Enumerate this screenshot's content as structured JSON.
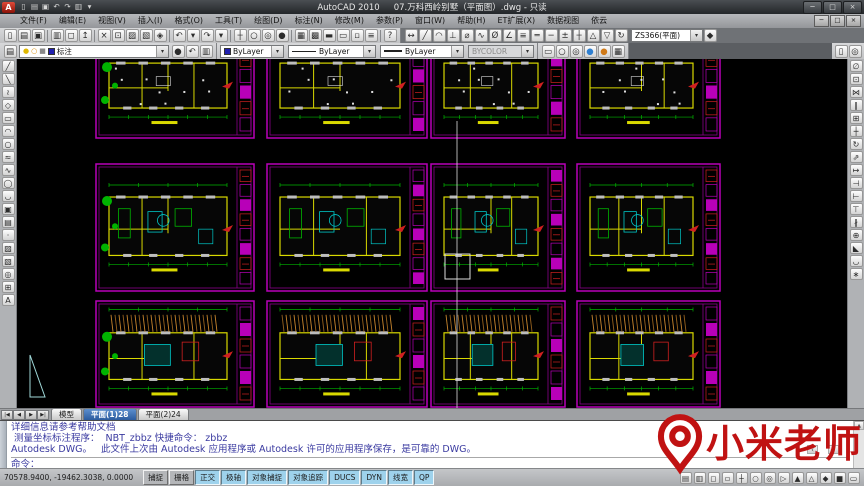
{
  "window": {
    "logo_letter": "A",
    "app_title": "AutoCAD 2010",
    "doc_title": "07.万科西岭别墅（平面图）.dwg - 只读",
    "controls": [
      {
        "name": "minimize",
        "glyph": "─"
      },
      {
        "name": "maximize",
        "glyph": "□"
      },
      {
        "name": "close",
        "glyph": "×"
      }
    ]
  },
  "quick_access": [
    {
      "name": "qnew",
      "glyph": "▯"
    },
    {
      "name": "open",
      "glyph": "▤"
    },
    {
      "name": "save",
      "glyph": "▣"
    },
    {
      "name": "undo",
      "glyph": "↶"
    },
    {
      "name": "redo",
      "glyph": "↷"
    },
    {
      "name": "plot",
      "glyph": "▥"
    },
    {
      "name": "qat-options",
      "glyph": "▾"
    }
  ],
  "menu": {
    "items": [
      "文件(F)",
      "编辑(E)",
      "视图(V)",
      "插入(I)",
      "格式(O)",
      "工具(T)",
      "绘图(D)",
      "标注(N)",
      "修改(M)",
      "参数(P)",
      "窗口(W)",
      "帮助(H)",
      "ET扩展(X)",
      "数据视图",
      "依云"
    ],
    "mdi_controls": [
      {
        "name": "mdi-minimize",
        "glyph": "─"
      },
      {
        "name": "mdi-restore",
        "glyph": "□"
      },
      {
        "name": "mdi-close",
        "glyph": "×"
      }
    ]
  },
  "toolbar_standard": [
    {
      "name": "qnew",
      "glyph": "▯"
    },
    {
      "name": "open",
      "glyph": "▤"
    },
    {
      "name": "save",
      "glyph": "▣"
    },
    {
      "name": "sep",
      "sep": true
    },
    {
      "name": "plot",
      "glyph": "▥"
    },
    {
      "name": "plot-preview",
      "glyph": "◻"
    },
    {
      "name": "publish",
      "glyph": "↥"
    },
    {
      "name": "sep",
      "sep": true
    },
    {
      "name": "cut",
      "glyph": "×"
    },
    {
      "name": "copy",
      "glyph": "⊡"
    },
    {
      "name": "paste",
      "glyph": "▨"
    },
    {
      "name": "match-properties",
      "glyph": "▧"
    },
    {
      "name": "block-editor",
      "glyph": "◈"
    },
    {
      "name": "sep",
      "sep": true
    },
    {
      "name": "undo",
      "glyph": "↶"
    },
    {
      "name": "undo-drop",
      "glyph": "▾"
    },
    {
      "name": "redo",
      "glyph": "↷"
    },
    {
      "name": "redo-drop",
      "glyph": "▾"
    },
    {
      "name": "sep",
      "sep": true
    },
    {
      "name": "pan",
      "glyph": "┼"
    },
    {
      "name": "zoom-realtime",
      "glyph": "○"
    },
    {
      "name": "zoom-window",
      "glyph": "◎"
    },
    {
      "name": "zoom-previous",
      "glyph": "●"
    },
    {
      "name": "sep",
      "sep": true
    },
    {
      "name": "properties",
      "glyph": "▦"
    },
    {
      "name": "designcenter",
      "glyph": "▩"
    },
    {
      "name": "tool-palettes",
      "glyph": "▬"
    },
    {
      "name": "sheetset-manager",
      "glyph": "▭"
    },
    {
      "name": "markup-manager",
      "glyph": "▫"
    },
    {
      "name": "quickcalc",
      "glyph": "≡"
    },
    {
      "name": "sep",
      "sep": true
    },
    {
      "name": "help",
      "glyph": "?"
    }
  ],
  "toolbar_dimension": {
    "icons": [
      {
        "name": "linear-dimension",
        "glyph": "↔"
      },
      {
        "name": "aligned-dimension",
        "glyph": "╱"
      },
      {
        "name": "arc-length-dimension",
        "glyph": "◠"
      },
      {
        "name": "ordinate-dimension",
        "glyph": "⊥"
      },
      {
        "name": "radius-dimension",
        "glyph": "⌀"
      },
      {
        "name": "jogged-dimension",
        "glyph": "∿"
      },
      {
        "name": "diameter-dimension",
        "glyph": "Ø"
      },
      {
        "name": "angular-dimension",
        "glyph": "∠"
      },
      {
        "name": "quick-dimension",
        "glyph": "≡"
      },
      {
        "name": "baseline-dimension",
        "glyph": "═"
      },
      {
        "name": "continue-dimension",
        "glyph": "─"
      },
      {
        "name": "tolerance",
        "glyph": "±"
      },
      {
        "name": "center-mark",
        "glyph": "┼"
      },
      {
        "name": "dimension-edit",
        "glyph": "△"
      },
      {
        "name": "dimension-text-edit",
        "glyph": "▽"
      },
      {
        "name": "dimension-update",
        "glyph": "↻"
      }
    ],
    "style_value": "ZS366(平面)",
    "tail_icon": {
      "name": "dim-style-control",
      "glyph": "◆"
    }
  },
  "toolbar_layers": {
    "manager_icon": {
      "name": "layer-properties-manager",
      "glyph": "▤"
    },
    "state_icons": [
      {
        "name": "layer-on-bulb",
        "glyph": "●",
        "color": "#e0b800"
      },
      {
        "name": "layer-freeze-sun",
        "glyph": "○",
        "color": "#d88a00"
      },
      {
        "name": "layer-lock",
        "glyph": "■",
        "color": "#8a8a8a"
      }
    ],
    "layer_swatch": "#2020b0",
    "layer_name": "标注",
    "after_icons": [
      {
        "name": "make-object-layer-current",
        "glyph": "●"
      },
      {
        "name": "layer-previous",
        "glyph": "↶"
      },
      {
        "name": "layer-states",
        "glyph": "▥"
      }
    ]
  },
  "toolbar_properties": {
    "color_swatch": "#2020b0",
    "color": "ByLayer",
    "linetype": "ByLayer",
    "lineweight": "ByLayer",
    "plot_style": "BYCOLOR"
  },
  "toolbar_render": [
    {
      "name": "hide",
      "glyph": "▭"
    },
    {
      "name": "wireframe",
      "glyph": "○"
    },
    {
      "name": "visual-styles",
      "glyph": "◎"
    },
    {
      "name": "shaded-sphere",
      "glyph": "●",
      "color": "#2f7fd0"
    },
    {
      "name": "realistic-sphere",
      "glyph": "●",
      "color": "#d07a18"
    },
    {
      "name": "render",
      "glyph": "▦"
    }
  ],
  "toolbar_corner": [
    {
      "name": "properties-palette",
      "glyph": "▯"
    },
    {
      "name": "quickcalc-palette",
      "glyph": "◎"
    }
  ],
  "draw_toolbar": [
    {
      "name": "line",
      "glyph": "╱"
    },
    {
      "name": "construction-line",
      "glyph": "╲"
    },
    {
      "name": "polyline",
      "glyph": "≀"
    },
    {
      "name": "polygon",
      "glyph": "◇"
    },
    {
      "name": "rectangle",
      "glyph": "▭"
    },
    {
      "name": "arc",
      "glyph": "◠"
    },
    {
      "name": "circle",
      "glyph": "○"
    },
    {
      "name": "revision-cloud",
      "glyph": "≈"
    },
    {
      "name": "spline",
      "glyph": "∿"
    },
    {
      "name": "ellipse",
      "glyph": "◯"
    },
    {
      "name": "ellipse-arc",
      "glyph": "◡"
    },
    {
      "name": "insert-block",
      "glyph": "▣"
    },
    {
      "name": "make-block",
      "glyph": "▤"
    },
    {
      "name": "point",
      "glyph": "·"
    },
    {
      "name": "hatch",
      "glyph": "▨"
    },
    {
      "name": "gradient",
      "glyph": "▧"
    },
    {
      "name": "region",
      "glyph": "◎"
    },
    {
      "name": "table",
      "glyph": "⊞"
    },
    {
      "name": "multiline-text",
      "glyph": "A"
    }
  ],
  "modify_toolbar": [
    {
      "name": "erase",
      "glyph": "∅"
    },
    {
      "name": "copy",
      "glyph": "⊡"
    },
    {
      "name": "mirror",
      "glyph": "⋈"
    },
    {
      "name": "offset",
      "glyph": "∥"
    },
    {
      "name": "array",
      "glyph": "⊞"
    },
    {
      "name": "move",
      "glyph": "┼"
    },
    {
      "name": "rotate",
      "glyph": "↻"
    },
    {
      "name": "scale",
      "glyph": "⇗"
    },
    {
      "name": "stretch",
      "glyph": "↦"
    },
    {
      "name": "trim",
      "glyph": "⊣"
    },
    {
      "name": "extend",
      "glyph": "⊢"
    },
    {
      "name": "break-at-point",
      "glyph": "⊤"
    },
    {
      "name": "break",
      "glyph": "∦"
    },
    {
      "name": "join",
      "glyph": "⊕"
    },
    {
      "name": "chamfer",
      "glyph": "◣"
    },
    {
      "name": "fillet",
      "glyph": "◡"
    },
    {
      "name": "explode",
      "glyph": "∗"
    }
  ],
  "layout_tabs": {
    "nav": [
      {
        "name": "tab-first",
        "glyph": "|◀"
      },
      {
        "name": "tab-prev",
        "glyph": "◀"
      },
      {
        "name": "tab-next",
        "glyph": "▶"
      },
      {
        "name": "tab-last",
        "glyph": "▶|"
      }
    ],
    "tabs": [
      {
        "label": "模型",
        "active": false
      },
      {
        "label": "平面(1)28",
        "active": true
      },
      {
        "label": "平面(2)24",
        "active": false
      }
    ]
  },
  "command": {
    "history": [
      "详细信息请参考帮助文档",
      " 测量坐标标注程序：  NBT_zbbz 快捷命令： zbbz",
      "Autodesk DWG。   此文件上次由 Autodesk 应用程序或 Autodesk 许可的应用程序保存，是可靠的 DWG。"
    ],
    "prompt": "命令：",
    "scroll": {
      "up": "▲",
      "left": "‹",
      "right": "›"
    }
  },
  "status_bar": {
    "coords": "70578.9400, -19462.3038, 0.0000",
    "toggles": [
      {
        "key": "snap",
        "label": "捕捉",
        "on": false
      },
      {
        "key": "grid",
        "label": "栅格",
        "on": false
      },
      {
        "key": "ortho",
        "label": "正交",
        "on": true
      },
      {
        "key": "polar",
        "label": "极轴",
        "on": true
      },
      {
        "key": "osnap",
        "label": "对象捕捉",
        "on": true
      },
      {
        "key": "otrack",
        "label": "对象追踪",
        "on": true
      },
      {
        "key": "ducs",
        "label": "DUCS",
        "on": true
      },
      {
        "key": "dyn",
        "label": "DYN",
        "on": true
      },
      {
        "key": "lwt",
        "label": "线宽",
        "on": true
      },
      {
        "key": "qp",
        "label": "QP",
        "on": true
      }
    ],
    "right_icons": [
      {
        "name": "model-space",
        "glyph": "▤"
      },
      {
        "name": "layout-space",
        "glyph": "▥"
      },
      {
        "name": "quick-view-layouts",
        "glyph": "◻"
      },
      {
        "name": "quick-view-drawings",
        "glyph": "▫"
      },
      {
        "name": "pan",
        "glyph": "┼"
      },
      {
        "name": "zoom",
        "glyph": "○"
      },
      {
        "name": "steering-wheel",
        "glyph": "◎"
      },
      {
        "name": "show-motion",
        "glyph": "▷"
      },
      {
        "name": "annotation-visibility",
        "glyph": "▲"
      },
      {
        "name": "annotation-autoscale",
        "glyph": "△"
      },
      {
        "name": "workspace-switching",
        "glyph": "◆"
      },
      {
        "name": "toolbar-lock",
        "glyph": "■"
      },
      {
        "name": "clean-screen",
        "glyph": "▭"
      }
    ]
  },
  "watermark": {
    "text": "小米老师",
    "color": "#c01212"
  },
  "canvas": {
    "background": "#000000",
    "palette": {
      "frame": "#b800b8",
      "frame2": "#8a008a",
      "wall": "#d9d900",
      "green": "#00b400",
      "cyan": "#00c8c8",
      "white": "#e0e0e0",
      "gray": "#bdbdbd",
      "red": "#d02020",
      "brown": "#96621e",
      "brown2": "#c8862e",
      "crosshair": "#dcdcdc",
      "triangle": "#9fd8d8"
    },
    "cols": [
      {
        "x": 79,
        "w": 158
      },
      {
        "x": 250,
        "w": 160
      },
      {
        "x": 414,
        "w": 134
      },
      {
        "x": 560,
        "w": 143
      }
    ],
    "rows": [
      {
        "y": -28,
        "h": 107,
        "variant": "ceiling"
      },
      {
        "y": 105,
        "h": 127,
        "variant": "furnished"
      },
      {
        "y": 242,
        "h": 106,
        "variant": "hatched"
      }
    ],
    "crosshair": {
      "x": 440,
      "y_top": 62,
      "y_bottom": 349,
      "box_x": 428,
      "box_y": 195,
      "box_size": 25
    },
    "triangle_points": "13,296 13,338 28,338"
  }
}
